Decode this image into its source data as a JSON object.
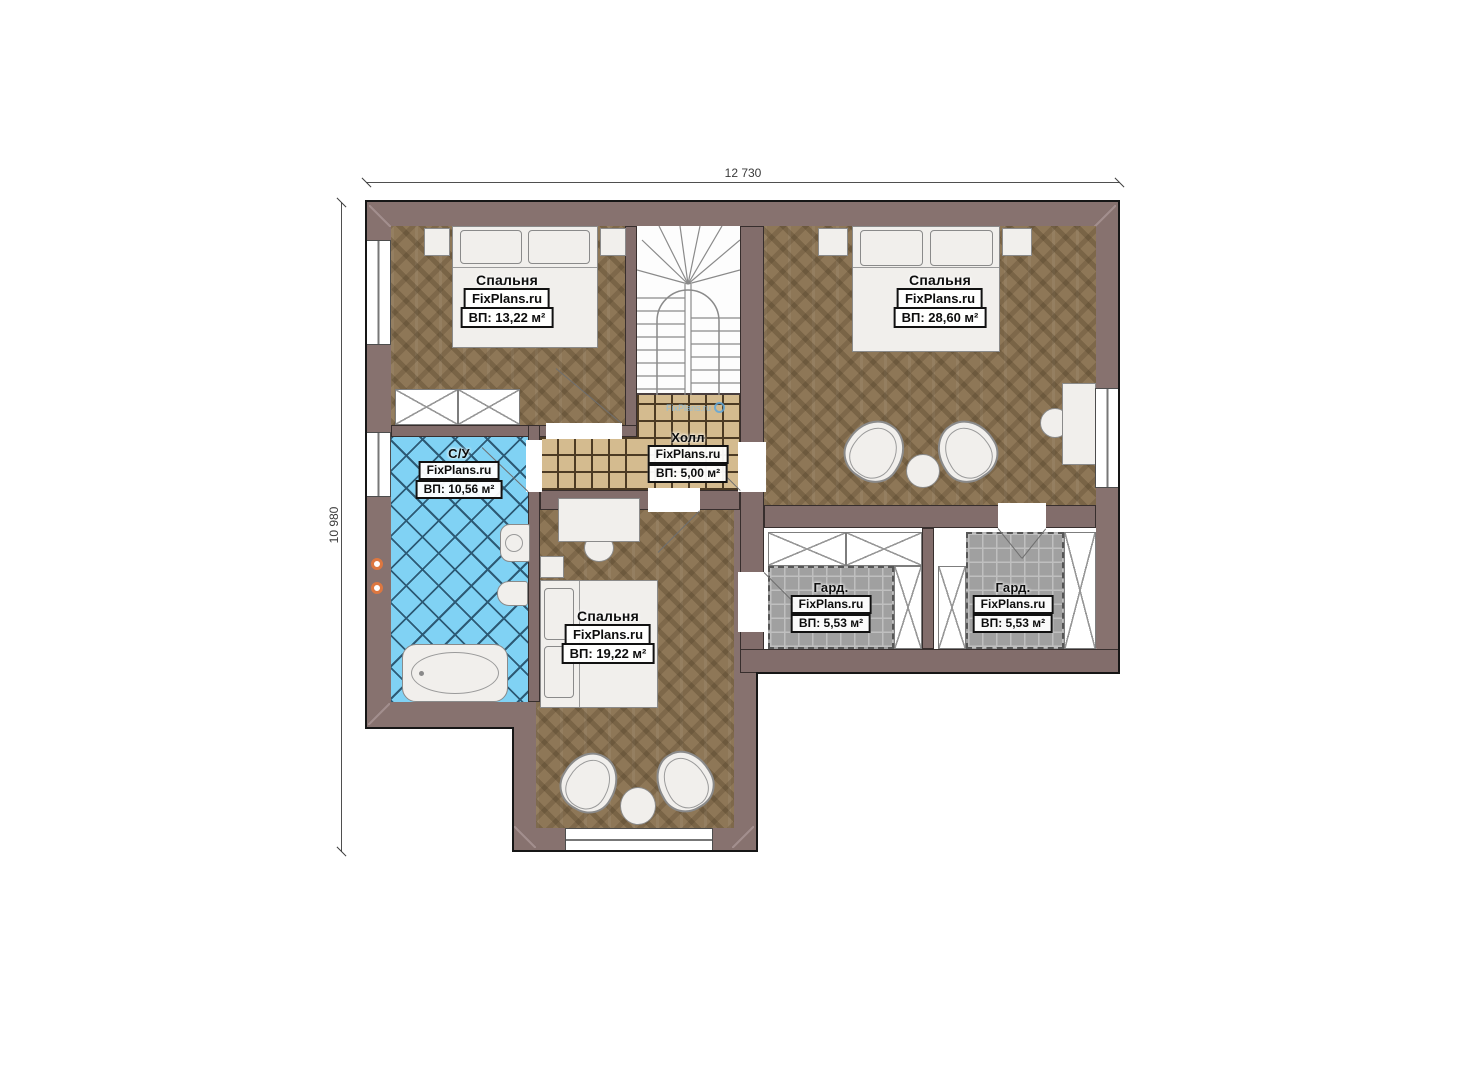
{
  "dimensions": {
    "top": "12 730",
    "left": "10 980"
  },
  "watermark": "FixPlans.ru",
  "rooms": {
    "bedroom1": {
      "name": "Спальня",
      "site": "FixPlans.ru",
      "area": "ВП: 13,22 м²"
    },
    "bedroom2": {
      "name": "Спальня",
      "site": "FixPlans.ru",
      "area": "ВП: 28,60 м²"
    },
    "bedroom3": {
      "name": "Спальня",
      "site": "FixPlans.ru",
      "area": "ВП: 19,22 м²"
    },
    "hall": {
      "name": "Холл",
      "site": "FixPlans.ru",
      "area": "ВП: 5,00 м²"
    },
    "bathroom": {
      "name": "С/У",
      "site": "FixPlans.ru",
      "area": "ВП: 10,56 м²"
    },
    "wardrobe1": {
      "name": "Гард.",
      "site": "FixPlans.ru",
      "area": "ВП: 5,53 м²"
    },
    "wardrobe2": {
      "name": "Гард.",
      "site": "FixPlans.ru",
      "area": "ВП: 5,53 м²"
    }
  },
  "colors": {
    "wall": "#87726f",
    "wood_floor": "#8e7757",
    "hall_tile": "#d4bb8f",
    "bath_tile": "#80d2f4",
    "wardrobe_tile": "#a0a0a0",
    "fixture_ring": "#dd7740",
    "watermark_blue": "#86bfe6"
  }
}
